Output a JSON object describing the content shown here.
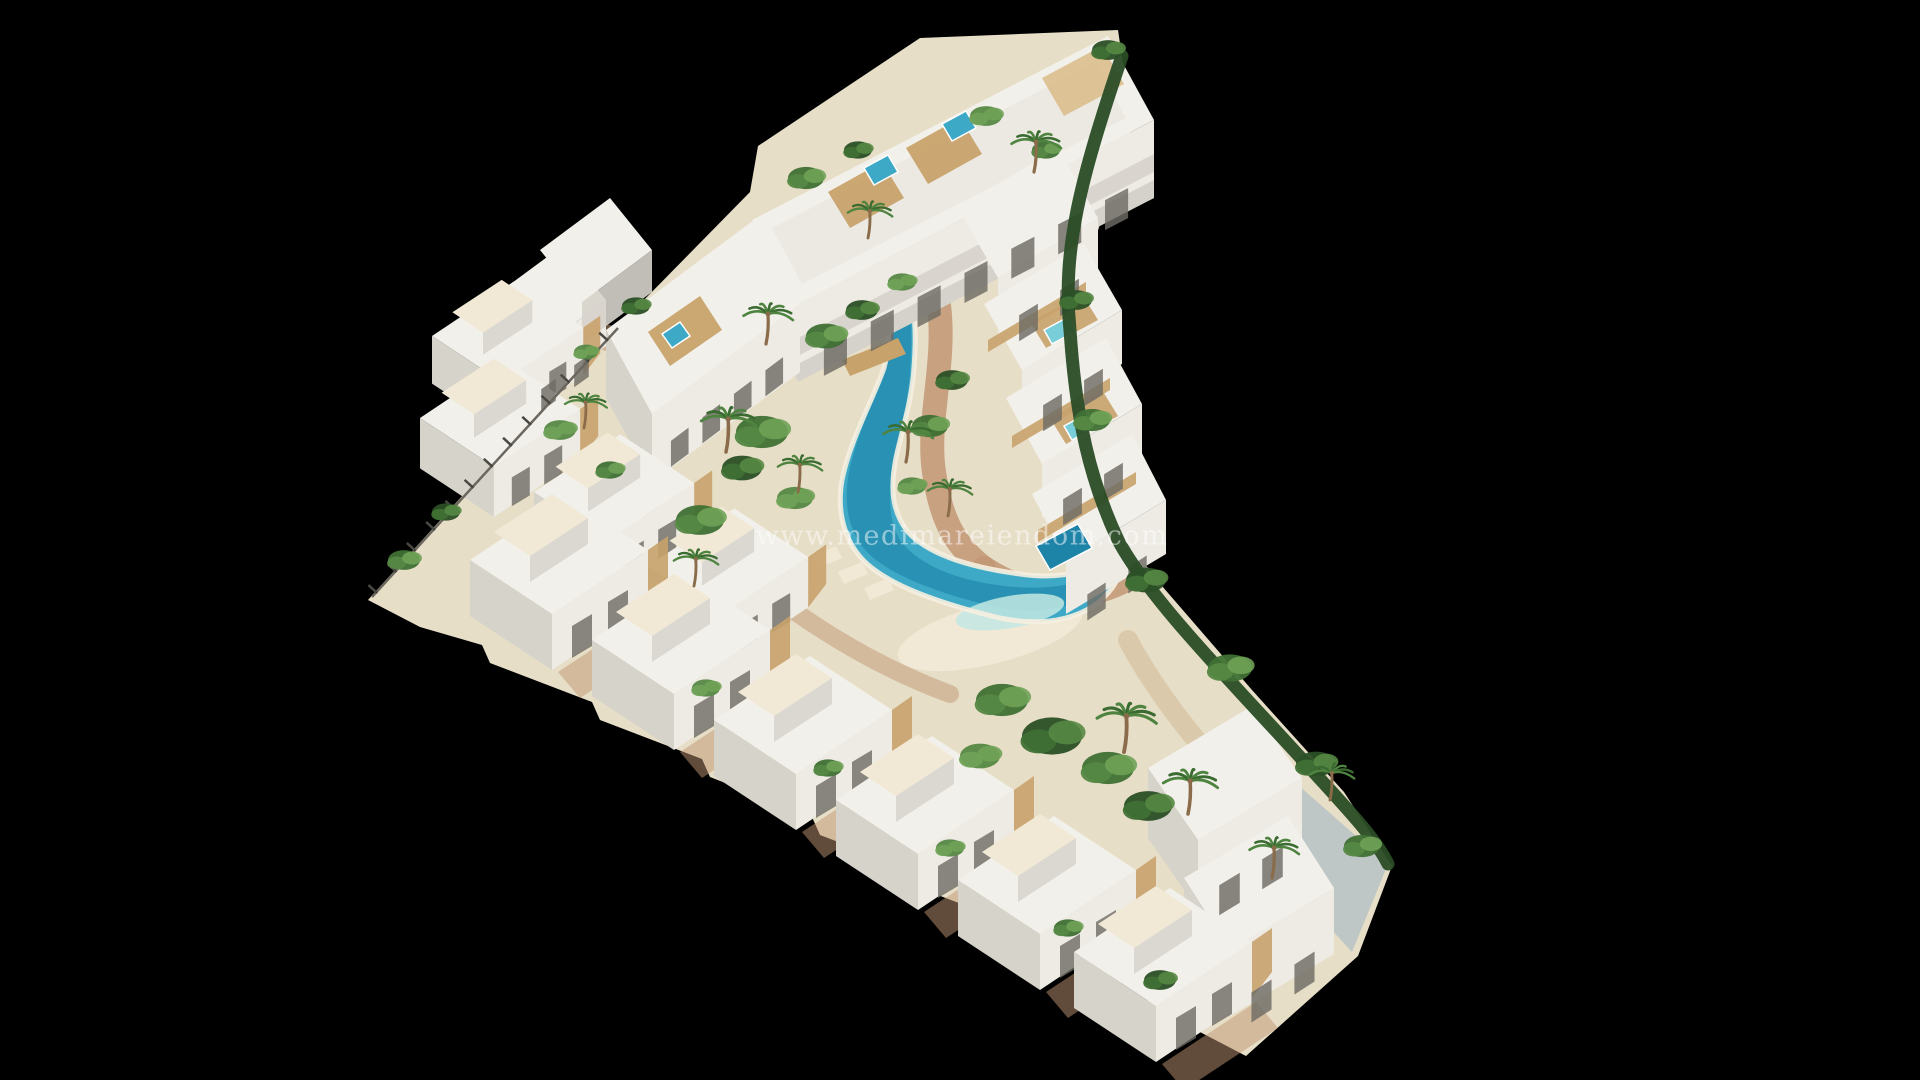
{
  "meta": {
    "width": 1920,
    "height": 1080,
    "background": "#000000"
  },
  "watermark": {
    "text": "www.medimareiendom.com",
    "x": 962,
    "y": 536,
    "font_size": 27,
    "letter_spacing": 1.5,
    "color": "#ffffff",
    "opacity": 0.5
  },
  "palette": {
    "sand": "#e7dec7",
    "sandLight": "#f1e9d6",
    "sandDark": "#d8c6a6",
    "terracotta": "#c29674",
    "terracottaDark": "#a97f5e",
    "wood": "#c8a26b",
    "woodLight": "#dcc091",
    "roofWhite": "#f2f0ea",
    "roofTex": "#e8e5dd",
    "facadeLight": "#edebe4",
    "facadeShade": "#d6d3cb",
    "facadeDark": "#bcb9b1",
    "opening": "#6e6b64",
    "glass": "#8fa0a6",
    "poolDeep": "#1d84a8",
    "poolMid": "#3da9c6",
    "poolLight": "#79cdd9",
    "poolShallow": "#c3e8e3",
    "shore": "#f6f0e0",
    "hedge": "#2a4c26",
    "trunk": "#8a6b4a",
    "palmA": "#3a6b31",
    "palmB": "#4e8440",
    "concrete": "#b9c4c4",
    "fenceDark": "#4a4842",
    "fenceLine": "#6b675f",
    "greens": [
      "#2b4f26",
      "#3f7034",
      "#568844",
      "#6fa257"
    ]
  },
  "scene": {
    "site": {
      "points": "368,600 560,388 622,324 642,302 750,192 758,146 920,38 1118,30 1132,126 1076,298 1066,380 1084,454 1112,522 1162,586 1252,690 1344,792 1392,866 1358,956 1246,1056 1150,1006 1142,988 1040,949 1032,931 930,892 922,874 820,835 812,817 710,777 702,759 600,720 592,702 490,663 482,645 420,627"
    },
    "beach": {
      "cx": 990,
      "cy": 634,
      "rx": 95,
      "ry": 30,
      "rot": -14,
      "fill": "sandLight",
      "opacity": 0.95
    },
    "paths": [
      {
        "name": "walkway-pool-right",
        "d": "M 938 298 C 948 360 926 420 934 472 C 940 514 952 544 984 568",
        "c": "terracotta",
        "w": 24,
        "o": 0.85
      },
      {
        "name": "walkway-pool-bottom",
        "d": "M 984 568 C 1034 600 1084 604 1130 578",
        "c": "terracotta",
        "w": 24,
        "o": 0.85
      },
      {
        "name": "walkway-pool-top",
        "d": "M 938 298 C 942 258 952 228 972 204",
        "c": "terracotta",
        "w": 20,
        "o": 0.8
      },
      {
        "name": "garden-path",
        "d": "M 1128 640 C 1160 700 1210 760 1262 812 C 1292 842 1312 872 1322 902",
        "c": "sandDark",
        "w": 20,
        "o": 0.9
      },
      {
        "name": "courtyard-upper",
        "d": "M 600 336 C 650 350 700 340 745 312",
        "c": "terracotta",
        "w": 26,
        "o": 0.55
      },
      {
        "name": "walkway-villas",
        "d": "M 560 470 C 640 500 700 540 760 586 C 820 632 880 668 950 694",
        "c": "terracotta",
        "w": 18,
        "o": 0.5
      }
    ],
    "pool": {
      "body": "M 893 292 C 886 318 892 340 884 368 C 872 402 850 440 842 480 C 836 515 846 548 872 568 C 900 590 950 606 1000 618 C 1048 628 1090 618 1112 588 C 1122 574 1122 562 1114 556 C 1090 572 1060 580 1020 574 C 975 568 930 556 908 532 C 892 512 890 488 896 458 C 902 430 912 400 914 368 C 916 340 916 316 910 292 Z",
      "deep": "M 893 300 C 886 330 890 352 884 372 C 872 404 854 442 848 478 C 843 512 852 542 876 560 C 902 580 948 596 996 607 C 1040 616 1080 608 1104 584 L 1096 574 C 1066 590 1028 590 990 584 C 948 577 916 562 900 540 C 888 520 888 494 894 464 C 900 434 908 402 910 372 C 912 344 912 318 908 300 Z",
      "top_quad": "886,282 912,282 910,300 888,300",
      "shallow": {
        "cx": 1010,
        "cy": 612,
        "rx": 55,
        "ry": 16,
        "rot": -10
      }
    },
    "quads": [
      {
        "n": "terrace-bulge",
        "p": "1290,778 1388,864 1352,952 1282,876",
        "f": "concrete",
        "o": 0.9
      },
      {
        "n": "apartment-block-roof",
        "p": "752,220 1108,36 1154,120 798,304",
        "f": "roofWhite",
        "o": 1
      },
      {
        "n": "apartment-block-rooftex",
        "p": "772,228 1096,62 1126,118 802,284",
        "f": "roofTex",
        "o": 0.7
      },
      {
        "n": "apartment-block-facade",
        "p": "798,304 1154,120 1154,198 798,382",
        "f": "facadeLight",
        "o": 1
      },
      {
        "n": "apartment-block-balcony-band",
        "p": "798,338 1154,154 1154,172 798,356",
        "f": "facadeShade",
        "o": 0.9
      },
      {
        "n": "apartment-block-plinth",
        "p": "798,364 1154,180 1154,198 798,382",
        "f": "facadeDark",
        "o": 0.5
      },
      {
        "n": "apartment-block-end",
        "p": "752,220 798,304 798,382 752,298",
        "f": "facadeShade",
        "o": 1
      },
      {
        "n": "roof-deck",
        "p": "828,192 882,162 904,198 850,228",
        "f": "wood",
        "o": 0.95
      },
      {
        "n": "roof-deck",
        "p": "906,148 960,118 982,154 928,184",
        "f": "wood",
        "o": 0.95
      },
      {
        "n": "roof-pergola",
        "p": "1042,78 1102,46 1124,84 1064,116",
        "f": "woodLight",
        "o": 0.95
      },
      {
        "n": "apartment-west-roof",
        "p": "606,330 754,220 800,304 652,414",
        "f": "roofWhite",
        "o": 1
      },
      {
        "n": "apartment-west-facade",
        "p": "652,414 800,304 800,372 652,482",
        "f": "facadeLight",
        "o": 1
      },
      {
        "n": "apartment-west-end",
        "p": "606,330 652,414 652,482 606,398",
        "f": "facadeShade",
        "o": 1
      },
      {
        "n": "roof-deck",
        "p": "648,332 700,296 722,330 670,366",
        "f": "wood",
        "o": 0.95
      },
      {
        "n": "villa-cluster-roof",
        "p": "478,308 562,246 606,300 522,362",
        "f": "roofWhite",
        "o": 1
      },
      {
        "n": "villa-cluster-facade",
        "p": "522,362 606,300 606,346 522,408",
        "f": "facadeLight",
        "o": 1
      },
      {
        "n": "villa-cluster-end",
        "p": "478,308 522,362 522,408 478,354",
        "f": "facadeShade",
        "o": 1
      },
      {
        "n": "villa-cluster-roof",
        "p": "540,250 610,198 652,250 582,302",
        "f": "roofWhite",
        "o": 1
      },
      {
        "n": "villa-cluster-facade",
        "p": "582,302 652,250 652,292 582,344",
        "f": "facadeShade",
        "o": 0.9
      },
      {
        "n": "terraced-unit-roof",
        "p": "958,208 1058,148 1098,218 998,278",
        "f": "roofWhite",
        "o": 1
      },
      {
        "n": "terraced-unit-facade",
        "p": "998,278 1098,218 1098,276 998,336",
        "f": "facadeLight",
        "o": 1
      },
      {
        "n": "terraced-unit-roof",
        "p": "984,304 1084,244 1122,310 1022,370",
        "f": "roofWhite",
        "o": 1
      },
      {
        "n": "terraced-unit-facade",
        "p": "1022,370 1122,310 1122,364 1022,424",
        "f": "facadeLight",
        "o": 1
      },
      {
        "n": "roof-deck",
        "p": "1030,322 1082,294 1098,320 1046,348",
        "f": "wood",
        "o": 0.9
      },
      {
        "n": "terraced-unit-roof",
        "p": "1006,398 1106,338 1142,404 1042,464",
        "f": "roofWhite",
        "o": 1
      },
      {
        "n": "terraced-unit-facade",
        "p": "1042,464 1142,404 1142,458 1042,518",
        "f": "facadeLight",
        "o": 1
      },
      {
        "n": "roof-deck",
        "p": "1050,418 1102,390 1118,416 1066,444",
        "f": "wood",
        "o": 0.9
      },
      {
        "n": "terraced-unit-roof",
        "p": "1032,494 1132,434 1166,500 1066,560",
        "f": "roofWhite",
        "o": 1
      },
      {
        "n": "terraced-unit-facade",
        "p": "1066,560 1166,500 1166,554 1066,614",
        "f": "facadeLight",
        "o": 1
      },
      {
        "n": "corner-villa-roof",
        "p": "1148,768 1252,706 1302,778 1198,840",
        "f": "roofWhite",
        "o": 1
      },
      {
        "n": "corner-villa-facade",
        "p": "1198,840 1302,778 1302,848 1198,910",
        "f": "facadeLight",
        "o": 1
      },
      {
        "n": "corner-villa-end",
        "p": "1148,768 1198,840 1198,910 1148,838",
        "f": "facadeShade",
        "o": 1
      },
      {
        "n": "corner-villa-roof",
        "p": "1184,878 1288,816 1334,888 1230,950",
        "f": "roofWhite",
        "o": 1
      },
      {
        "n": "corner-villa-facade",
        "p": "1230,950 1334,888 1334,954 1230,1016",
        "f": "facadeLight",
        "o": 1
      },
      {
        "n": "corner-villa-end",
        "p": "1184,878 1230,950 1230,1016 1184,944",
        "f": "facadeShade",
        "o": 1
      },
      {
        "n": "slat-fence",
        "p": "988,340 1086,282 1086,294 988,352",
        "f": "wood",
        "o": 0.9
      },
      {
        "n": "slat-fence",
        "p": "1012,436 1110,378 1110,390 1012,448",
        "f": "wood",
        "o": 0.9
      },
      {
        "n": "slat-fence",
        "p": "1038,530 1136,472 1136,484 1038,542",
        "f": "wood",
        "o": 0.9
      },
      {
        "n": "pool-bridge",
        "p": "842,360 898,338 906,354 850,376",
        "f": "wood",
        "o": 1
      },
      {
        "n": "sun-lounger",
        "p": "812,556 836,546 842,558 818,568",
        "f": "sandLight",
        "o": 0.95
      },
      {
        "n": "sun-lounger",
        "p": "838,572 862,562 868,574 844,584",
        "f": "sandLight",
        "o": 0.95
      },
      {
        "n": "sun-lounger",
        "p": "864,588 888,578 894,590 870,600",
        "f": "sandLight",
        "o": 0.95
      }
    ],
    "minipools": [
      {
        "n": "rooftop-plunge-pool",
        "p": "864,168 888,155 898,172 874,185",
        "f": "poolMid"
      },
      {
        "n": "rooftop-plunge-pool",
        "p": "942,124 966,111 976,128 952,141",
        "f": "poolMid"
      },
      {
        "n": "rooftop-plunge-pool",
        "p": "662,334 680,322 690,336 672,348",
        "f": "poolMid"
      },
      {
        "n": "rooftop-jacuzzi",
        "p": "1044,330 1068,317 1076,331 1052,344",
        "f": "poolLight"
      },
      {
        "n": "rooftop-jacuzzi",
        "p": "1064,426 1088,413 1096,427 1072,440",
        "f": "poolLight"
      },
      {
        "n": "private-pool",
        "p": "1036,546 1078,524 1092,548 1050,570",
        "f": "poolDeep"
      }
    ],
    "windows": [
      {
        "from": [
          812,
          352
        ],
        "to": [
          1140,
          182
        ],
        "n": 7,
        "w": 26,
        "h": 30
      },
      {
        "from": [
          664,
          446
        ],
        "to": [
          790,
          352
        ],
        "n": 4,
        "w": 22,
        "h": 26
      },
      {
        "from": [
          1008,
          322
        ],
        "to": [
          1090,
          272
        ],
        "n": 2,
        "w": 22,
        "h": 26
      },
      {
        "from": [
          1032,
          412
        ],
        "to": [
          1114,
          362
        ],
        "n": 2,
        "w": 22,
        "h": 26
      },
      {
        "from": [
          1052,
          506
        ],
        "to": [
          1134,
          456
        ],
        "n": 2,
        "w": 22,
        "h": 26
      },
      {
        "from": [
          1076,
          602
        ],
        "to": [
          1158,
          548
        ],
        "n": 2,
        "w": 22,
        "h": 26
      },
      {
        "from": [
          1208,
          892
        ],
        "to": [
          1294,
          840
        ],
        "n": 2,
        "w": 24,
        "h": 30
      },
      {
        "from": [
          1240,
          1000
        ],
        "to": [
          1326,
          944
        ],
        "n": 2,
        "w": 24,
        "h": 30
      },
      {
        "from": [
          532,
          396
        ],
        "to": [
          598,
          348
        ],
        "n": 2,
        "w": 18,
        "h": 22
      }
    ],
    "villas": {
      "template": [
        {
          "n": "villa-roof",
          "p": [
            [
              0,
              0
            ],
            [
              96,
              -64
            ],
            [
              178,
              -10
            ],
            [
              82,
              54
            ]
          ],
          "f": "roofWhite",
          "o": 1
        },
        {
          "n": "villa-tower-roof",
          "p": [
            [
              24,
              -28
            ],
            [
              82,
              -66
            ],
            [
              118,
              -42
            ],
            [
              60,
              -4
            ]
          ],
          "f": "sandLight",
          "o": 1
        },
        {
          "n": "villa-tower-facade",
          "p": [
            [
              60,
              -4
            ],
            [
              118,
              -42
            ],
            [
              118,
              -16
            ],
            [
              60,
              22
            ]
          ],
          "f": "facadeShade",
          "o": 0.85
        },
        {
          "n": "villa-facade",
          "p": [
            [
              82,
              54
            ],
            [
              178,
              -10
            ],
            [
              178,
              46
            ],
            [
              82,
              110
            ]
          ],
          "f": "facadeLight",
          "o": 1
        },
        {
          "n": "villa-end-wall",
          "p": [
            [
              0,
              0
            ],
            [
              82,
              54
            ],
            [
              82,
              110
            ],
            [
              0,
              56
            ]
          ],
          "f": "facadeShade",
          "o": 1
        },
        {
          "n": "villa-wood-slats",
          "p": [
            [
              178,
              -10
            ],
            [
              198,
              -24
            ],
            [
              198,
              20
            ],
            [
              178,
              46
            ]
          ],
          "f": "wood",
          "o": 0.9
        },
        {
          "n": "villa-terrace",
          "p": [
            [
              88,
              112
            ],
            [
              182,
              50
            ],
            [
              204,
              76
            ],
            [
              110,
              138
            ]
          ],
          "f": "terracotta",
          "o": 0.5,
          "frontOnly": true
        },
        {
          "n": "villa-window",
          "p": [
            [
              102,
              66
            ],
            [
              122,
              54
            ],
            [
              122,
              86
            ],
            [
              102,
              98
            ]
          ],
          "f": "opening",
          "o": 0.8
        },
        {
          "n": "villa-window",
          "p": [
            [
              138,
              42
            ],
            [
              158,
              30
            ],
            [
              158,
              62
            ],
            [
              138,
              74
            ]
          ],
          "f": "opening",
          "o": 0.8
        }
      ],
      "back": [
        [
          432,
          336,
          0.85
        ],
        [
          420,
          418,
          0.9
        ],
        [
          534,
          492,
          0.9
        ],
        [
          648,
          566,
          0.9
        ]
      ],
      "front": [
        [
          470,
          560,
          1
        ],
        [
          592,
          640,
          1
        ],
        [
          714,
          720,
          1
        ],
        [
          836,
          800,
          1
        ],
        [
          958,
          880,
          1
        ],
        [
          1074,
          952,
          1
        ]
      ]
    },
    "hedge": {
      "d": "M 1122 56 C 1080 180 1062 250 1070 330 C 1076 420 1090 480 1118 540 C 1150 600 1230 680 1310 768 C 1350 812 1375 838 1388 864",
      "w": 13
    },
    "fence": {
      "x1": 372,
      "y1": 597,
      "x2": 618,
      "y2": 328
    },
    "greens": [
      [
        762,
        432,
        26,
        2
      ],
      [
        742,
        468,
        20,
        1
      ],
      [
        700,
        520,
        24,
        2
      ],
      [
        795,
        498,
        18,
        3
      ],
      [
        826,
        336,
        20,
        2
      ],
      [
        862,
        310,
        16,
        1
      ],
      [
        902,
        282,
        14,
        3
      ],
      [
        930,
        426,
        18,
        2
      ],
      [
        952,
        380,
        16,
        1
      ],
      [
        912,
        486,
        14,
        3
      ],
      [
        1002,
        700,
        26,
        2
      ],
      [
        1052,
        736,
        30,
        1
      ],
      [
        1108,
        768,
        26,
        2
      ],
      [
        980,
        756,
        20,
        3
      ],
      [
        1148,
        806,
        24,
        1
      ],
      [
        1076,
        300,
        16,
        1
      ],
      [
        1092,
        420,
        18,
        2
      ],
      [
        1146,
        580,
        20,
        1
      ],
      [
        1230,
        668,
        22,
        2
      ],
      [
        1316,
        764,
        20,
        1
      ],
      [
        1362,
        846,
        18,
        2
      ],
      [
        806,
        178,
        18,
        2
      ],
      [
        858,
        150,
        14,
        1
      ],
      [
        986,
        116,
        16,
        3
      ],
      [
        1046,
        150,
        14,
        2
      ],
      [
        1108,
        50,
        16,
        1
      ],
      [
        404,
        560,
        16,
        2
      ],
      [
        446,
        512,
        14,
        1
      ],
      [
        560,
        430,
        16,
        3
      ],
      [
        610,
        470,
        14,
        2
      ],
      [
        706,
        688,
        14,
        3
      ],
      [
        828,
        768,
        14,
        2
      ],
      [
        950,
        848,
        14,
        3
      ],
      [
        1068,
        928,
        14,
        2
      ],
      [
        1160,
        980,
        16,
        1
      ],
      [
        636,
        306,
        14,
        1
      ],
      [
        586,
        352,
        12,
        3
      ]
    ],
    "palms": [
      [
        766,
        344,
        1.0
      ],
      [
        726,
        452,
        1.1
      ],
      [
        798,
        492,
        0.9
      ],
      [
        906,
        462,
        1.0
      ],
      [
        948,
        516,
        0.9
      ],
      [
        1124,
        752,
        1.2
      ],
      [
        1188,
        814,
        1.1
      ],
      [
        1272,
        878,
        1.0
      ],
      [
        1034,
        172,
        1.0
      ],
      [
        868,
        238,
        0.9
      ],
      [
        584,
        428,
        0.85
      ],
      [
        694,
        586,
        0.9
      ],
      [
        1330,
        800,
        0.9
      ]
    ]
  }
}
